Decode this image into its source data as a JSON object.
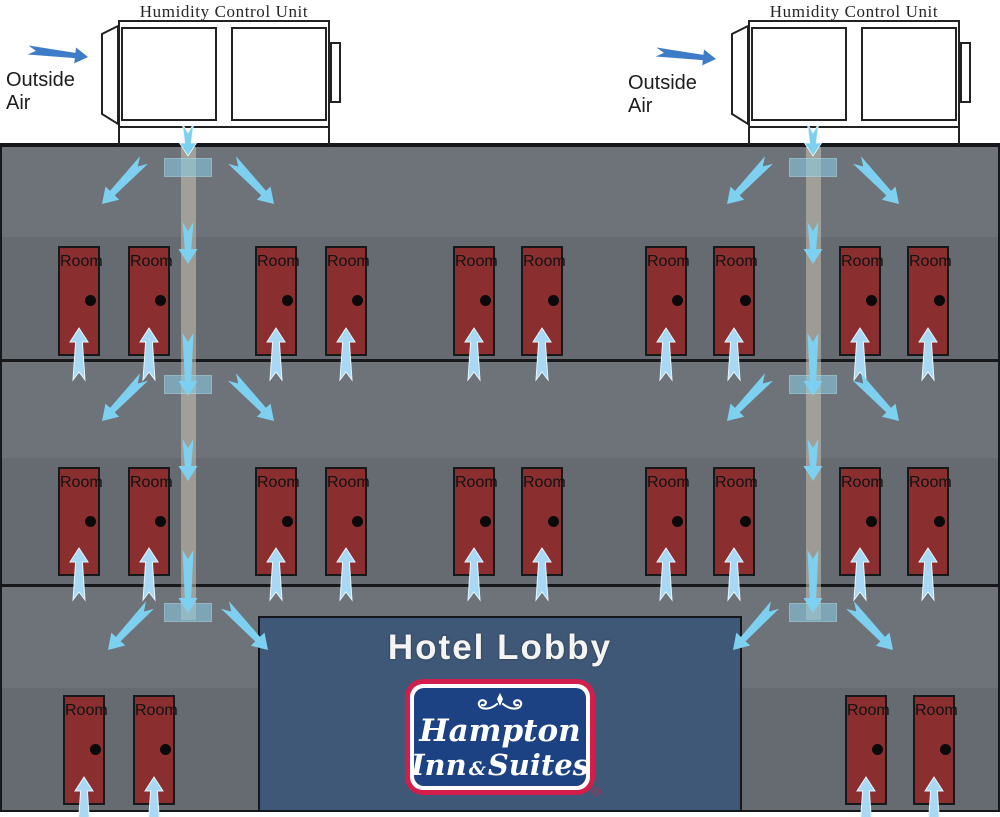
{
  "colors": {
    "building_gray": "#6E737A",
    "floor_band_gray": "#666B72",
    "outline_dark": "#17181A",
    "door_red": "#8B2E30",
    "airflow_blue": "#7ED0F0",
    "room_supply_blue": "#A8D8F4",
    "outside_air_blue": "#3E7CC7",
    "duct_tan": "rgba(202,194,176,0.55)",
    "diffuser_blue": "rgba(140,205,230,0.55)",
    "lobby_blue": "#3F5877",
    "lobby_text": "#F4F4F2",
    "logo_red": "#D21E4B",
    "logo_blue": "#1C4284"
  },
  "units": {
    "left": {
      "title": "Humidity Control Unit",
      "intake_label": "Outside Air"
    },
    "right": {
      "title": "Humidity Control Unit",
      "intake_label": "Outside Air"
    }
  },
  "building": {
    "floors": [
      {
        "door_labels": [
          "Room",
          "Room",
          "Room",
          "Room",
          "Room",
          "Room",
          "Room",
          "Room",
          "Room",
          "Room"
        ]
      },
      {
        "door_labels": [
          "Room",
          "Room",
          "Room",
          "Room",
          "Room",
          "Room",
          "Room",
          "Room",
          "Room",
          "Room"
        ]
      },
      {
        "door_labels": [
          "Room",
          "Room",
          "Room",
          "Room"
        ]
      }
    ]
  },
  "lobby": {
    "title": "Hotel Lobby",
    "logo": {
      "word_top": "Hampton",
      "word_inn": "Inn",
      "ampersand": "&",
      "word_suites": "Suites",
      "registered_mark": "®"
    }
  }
}
